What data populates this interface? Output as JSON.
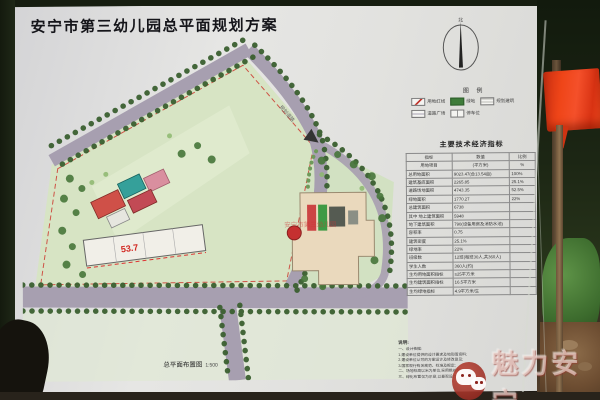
{
  "photo": {
    "watermark_text": "魅力安宁"
  },
  "board": {
    "title": "安宁市第三幼儿园总平面规划方案",
    "compass": {
      "north_label": "北"
    },
    "legend": {
      "title": "图 例",
      "items": [
        {
          "label": "用地红线",
          "type": "redline"
        },
        {
          "label": "绿地",
          "type": "green"
        },
        {
          "label": "规划建筑",
          "type": "building"
        },
        {
          "label": "道路广场",
          "type": "road"
        },
        {
          "label": "停车位",
          "type": "parking"
        }
      ]
    },
    "table": {
      "title": "主要技术经济指标",
      "headers": [
        "指标",
        "数值",
        "比例"
      ],
      "unit_row": [
        "用地项目",
        "(平方米)",
        "%"
      ],
      "rows": [
        [
          "总用地面积",
          "9023.47(合13.54亩)",
          "100%"
        ],
        [
          "建筑基底面积",
          "2265.85",
          "25.1%"
        ],
        [
          "道路场地面积",
          "4743.35",
          "52.5%"
        ],
        [
          "绿地面积",
          "1770.27",
          "22%"
        ],
        [
          "总建筑面积",
          "6738",
          ""
        ],
        [
          "其中 地上建筑面积",
          "5948",
          ""
        ],
        [
          "地下建筑面积",
          "790(设备用房及消防水池)",
          ""
        ],
        [
          "容积率",
          "0.75",
          ""
        ],
        [
          "建筑密度",
          "25.1%",
          ""
        ],
        [
          "绿地率",
          "22%",
          ""
        ],
        [
          "班级数",
          "12班(每班30人,共360人)",
          ""
        ],
        [
          "学生人数",
          "360人(约)",
          ""
        ],
        [
          "生均用地面积指标",
          "≥25平方米",
          ""
        ],
        [
          "生均建筑面积指标",
          "16.5平方米",
          ""
        ],
        [
          "生均绿地指标",
          "4.9平方米/生",
          ""
        ]
      ]
    },
    "notes": {
      "title": "说明:",
      "lines": [
        "一、设计依据:",
        "1.建设单位提供的设计要求及地形图资料;",
        "2.建设单位认可的方案设计及修改意见;",
        "3.国家现行有关规范、标准及规定;",
        "二、场地标高以米为单位,采用绝对标高;",
        "三、绿化布置仅为示意,以景观设计为准。"
      ]
    },
    "plan": {
      "sheet_label": "总平面布置图",
      "sheet_scale": "1:500",
      "elevation_label": "53.7",
      "road_label": "规划道路",
      "site_name_overlay": "安宁市第三幼儿园"
    }
  }
}
